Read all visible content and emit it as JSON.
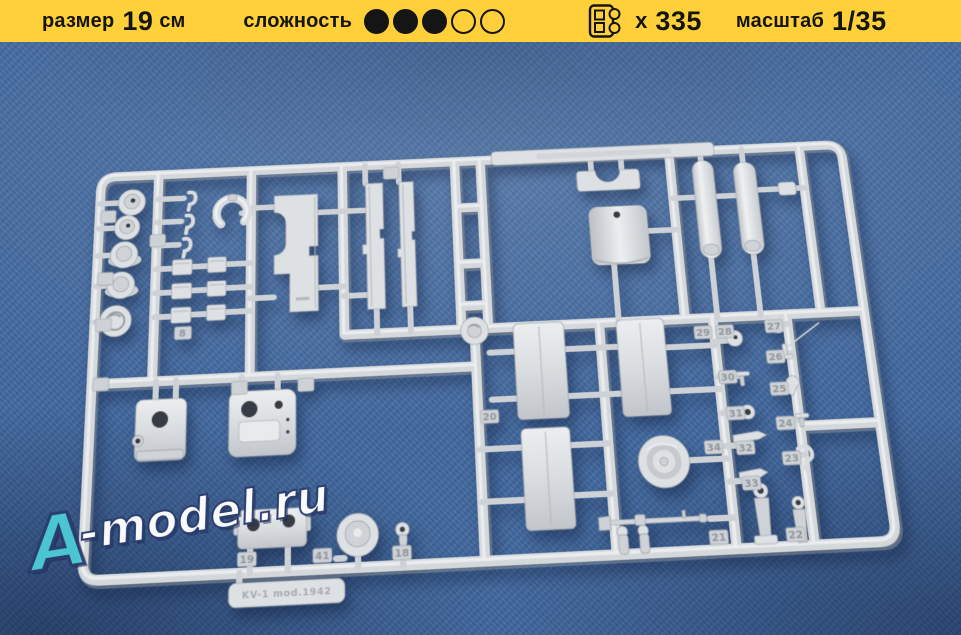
{
  "header": {
    "size": {
      "label": "размер",
      "value": "19",
      "unit": "см"
    },
    "difficulty": {
      "label": "сложность",
      "filled": 3,
      "total": 5
    },
    "parts_count": {
      "prefix": "x",
      "value": "335"
    },
    "scale": {
      "label": "масштаб",
      "value": "1/35"
    }
  },
  "photo": {
    "watermark": {
      "accent": "A",
      "rest": "-model.ru"
    },
    "sprue": {
      "label": "KV-1 mod.1942",
      "part_numbers": {
        "p8": "8",
        "p18": "18",
        "p19": "19",
        "p20": "20",
        "p21": "21",
        "p22": "22",
        "p23": "23",
        "p24": "24",
        "p25": "25",
        "p26": "26",
        "p27": "27",
        "p28": "28",
        "p29": "29",
        "p30": "30",
        "p31": "31",
        "p32": "32",
        "p33": "33",
        "p34": "34",
        "p41": "41"
      }
    }
  },
  "colors": {
    "header-bg": "#FFD039",
    "header-text": "#15150f",
    "photo-bg": "#41689e",
    "plastic": "#d8dbde",
    "wm-accent": "#4cc9d3",
    "wm-outline": "#2b3c6e"
  }
}
